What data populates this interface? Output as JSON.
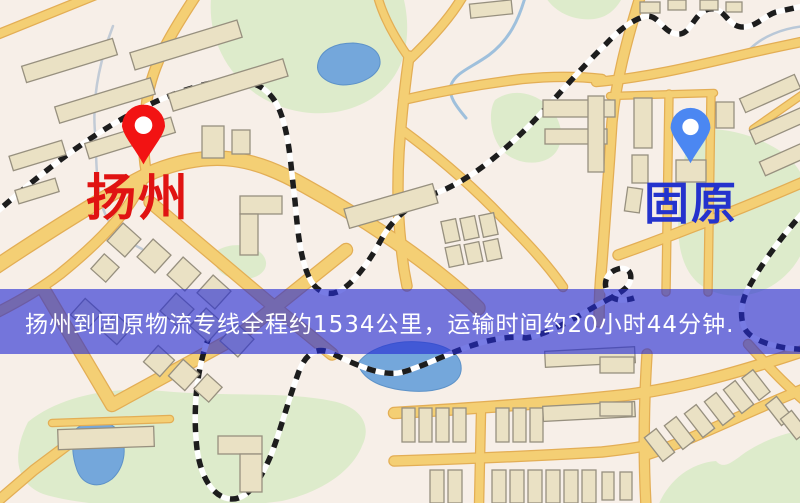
{
  "page": {
    "type": "logistics-route-map"
  },
  "banner": {
    "text": "扬州到固原物流专线全程约1534公里，运输时间约20小时44分钟.",
    "distance": "1534公里",
    "duration": "20小时44分钟",
    "bg_color": "rgba(35,42,212,0.62)",
    "text_color": "#ffffff"
  },
  "markers": {
    "origin": {
      "name": "扬州",
      "pin_color": "#f21313",
      "label_color": "#e01312"
    },
    "destination": {
      "name": "固原",
      "pin_color": "#4b87f2",
      "label_color": "#2433cd"
    }
  },
  "map_colors": {
    "land": "#f7efe8",
    "road": "#f4cf74",
    "road_casing": "#e3ae55",
    "park": "#ddebcb",
    "water": "#74a7db",
    "building": "#eae1c4",
    "railway_dash": "#1d1d1d"
  }
}
